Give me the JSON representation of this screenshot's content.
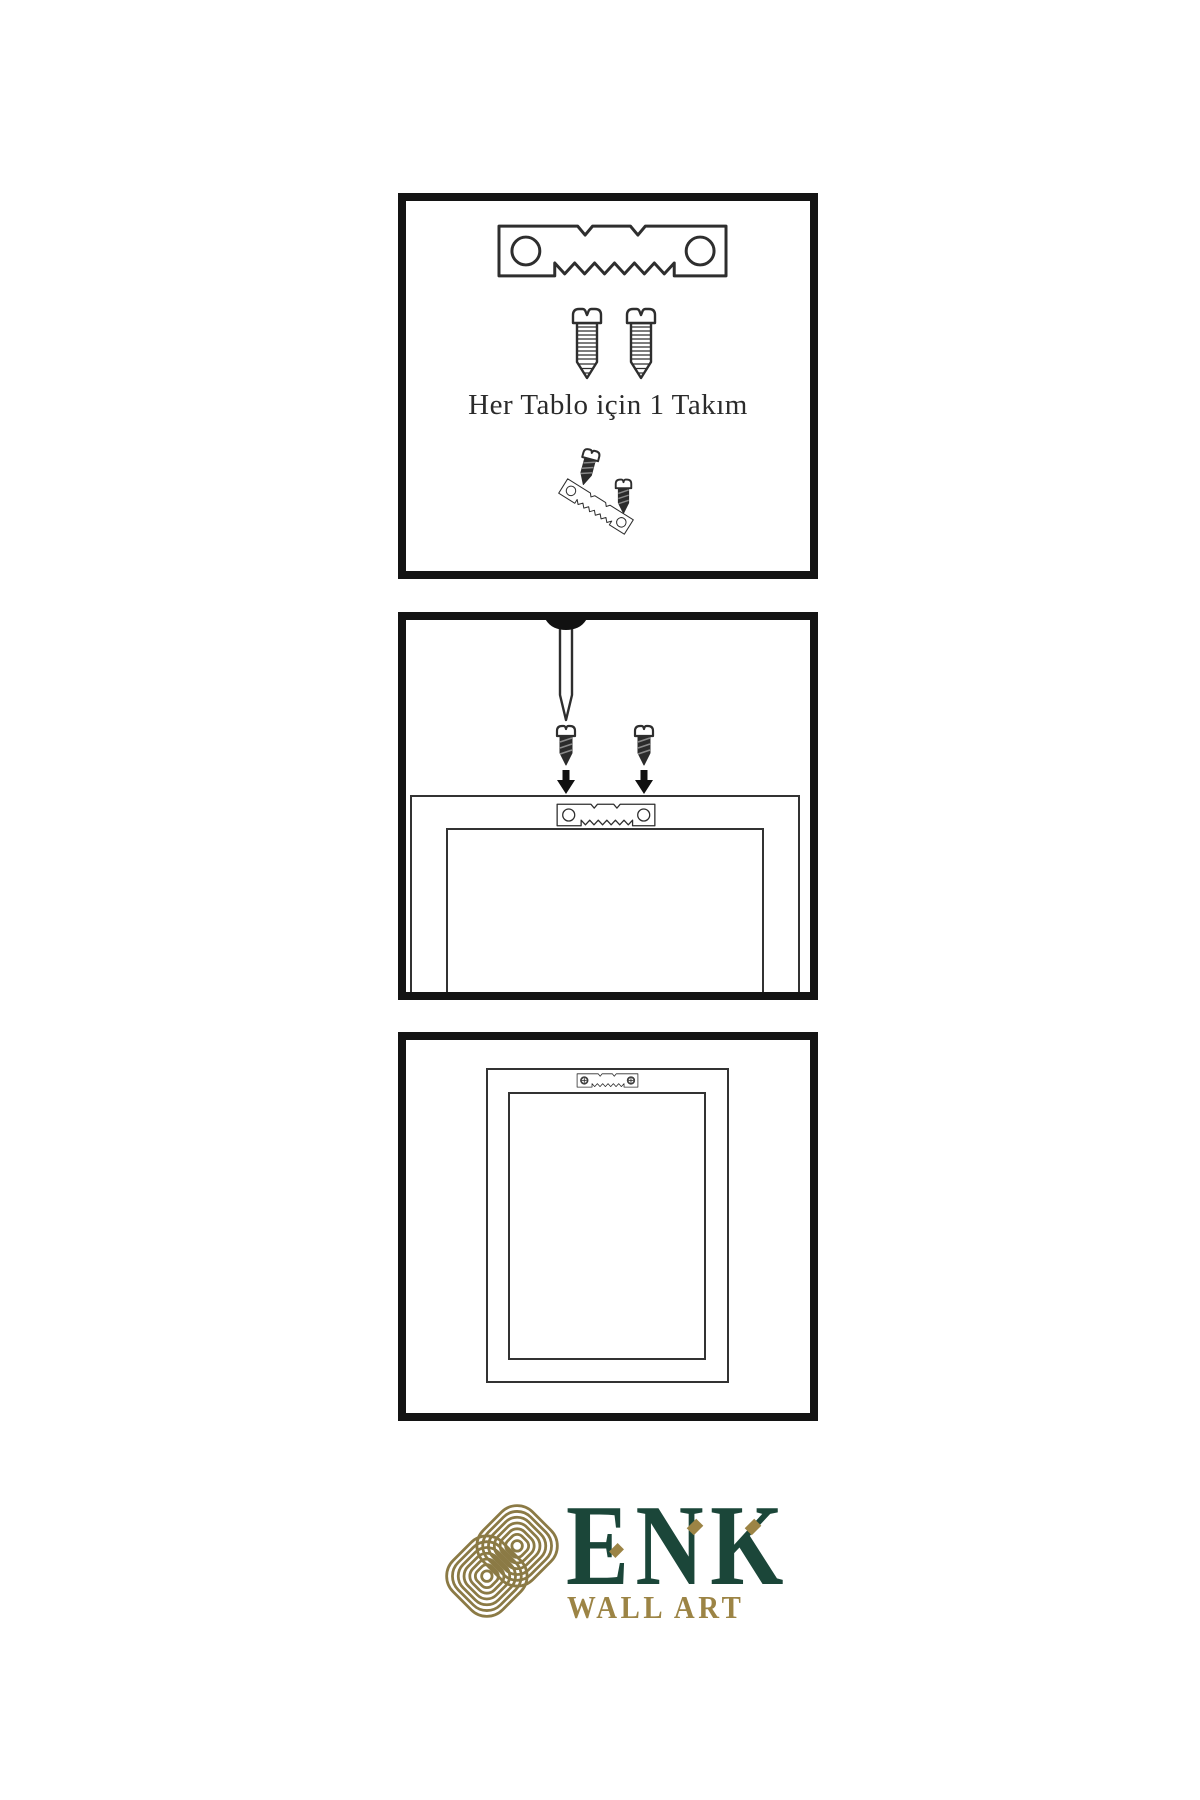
{
  "page": {
    "background": "#ffffff"
  },
  "steps": [
    {
      "name": "hardware-set",
      "caption": "Her Tablo için 1 Takım",
      "parts": [
        "sawtooth-hanger",
        "screw",
        "screw",
        "screw-tilted",
        "sawtooth-hanger-tilted",
        "screw-small"
      ]
    },
    {
      "name": "mount-hanger-on-frame",
      "parts": [
        "wall-nail",
        "screw",
        "screw",
        "arrow-down",
        "arrow-down",
        "sawtooth-hanger",
        "frame-back"
      ]
    },
    {
      "name": "hang-frame-on-wall",
      "parts": [
        "frame-back",
        "sawtooth-hanger-mounted-with-screws"
      ]
    }
  ],
  "logo": {
    "brand": "ENK",
    "subtitle": "WALL ART",
    "colors": {
      "brand_green": "#1b4639",
      "gold": "#9c8445",
      "knot_gold": "#8b7a45"
    }
  },
  "colors": {
    "panel_border": "#141414",
    "line_art": "#2e2e2e",
    "text": "#2b2b2b"
  }
}
